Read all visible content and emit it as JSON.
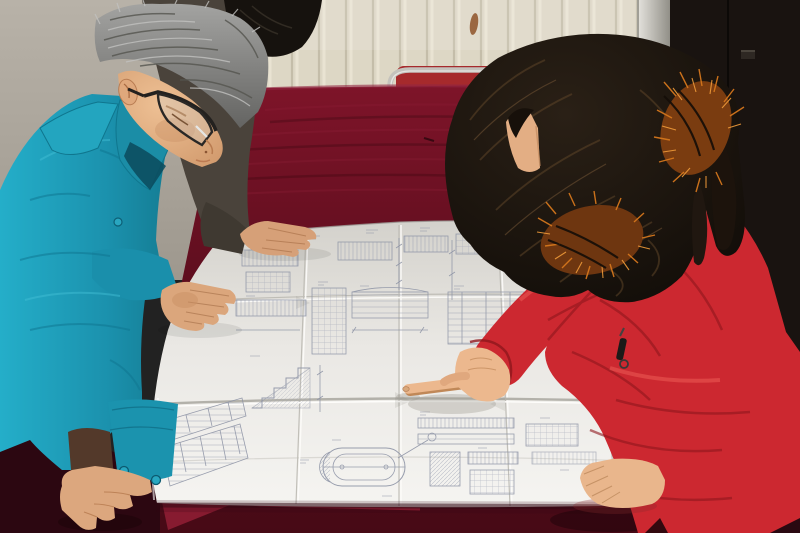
{
  "meta": {
    "type": "photograph",
    "description": "Two workers lean over a large folded engineering blueprint spread on a dark red velvet-covered table. A gray-haired man wearing black glasses and a teal work jacket studies the plans; a woman in a red quilted down coat with an orange fur-trimmed hood points at a detail with her right index finger. A third person in a dark jacket rests a hand on the top of the sheet.",
    "width": 800,
    "height": 533
  },
  "scene": {
    "background": {
      "left_wall": "plain gray plaster wall",
      "center_wall": "cream vertical-panel radiator wall with rust drip stains",
      "right_door": "dark brown metal door with small latch",
      "chair": "metal-tube frame chair with dark red cushion behind the table"
    },
    "table": {
      "covering": "dark burgundy velvet cloth draped over large table"
    },
    "blueprint": {
      "kind": "folded engineering construction drawing",
      "features": [
        "fold creases in a grid pattern",
        "elevation strips with dense tick marks",
        "stair section with hatched fill",
        "rotated title-block tables at lower left",
        "stadium-shaped component detail",
        "hatched section blocks and dimension chains"
      ]
    },
    "people": [
      {
        "id": "man-left",
        "hair": "gray",
        "eyewear": "black rectangular glasses",
        "clothing": "teal work jacket with snap cuffs",
        "pose": "leaning over table, both hands on the sheet"
      },
      {
        "id": "person-behind",
        "hair": "black",
        "clothing": "dark brown jacket",
        "pose": "hand resting on top edge of the sheet"
      },
      {
        "id": "woman-right",
        "hair": "long dark wavy",
        "clothing": "red quilted down coat, orange fur-trimmed hood, black zipper pull",
        "pose": "pointing at the drawing, left hand resting on sheet"
      }
    ]
  },
  "colors": {
    "wall_gray": "#aca69c",
    "wall_cream": "#ddd7c5",
    "panel_shadow": "#c2bba6",
    "panel_light": "#eae5d4",
    "door_dark": "#191310",
    "rust": "#8a4a1e",
    "chair_metal": "#c4c2bc",
    "chair_seat": "#a62a2c",
    "velvet_top": "#7e1429",
    "velvet_mid": "#5e0e1e",
    "velvet_dark": "#470a16",
    "velvet_edge": "#a3223a",
    "velvet_shadow": "#2c0711",
    "paper_mid": "#eae8e4",
    "line_blue": "#8e94a6",
    "jacket_mid": "#1b91ad",
    "jacket_dark": "#13798f",
    "man_hair": "#8f8f8d",
    "skin": "#e2af85",
    "skin_shadow": "#bd8a5c",
    "glasses_black": "#23211f",
    "back_jacket": "#4a433b",
    "back_hair": "#16120e",
    "coat_red": "#cc2830",
    "coat_deep": "#8f161d",
    "woman_hair": "#1b130d",
    "fur_orange": "#d4761c",
    "sleeve_lining": "#53392a"
  }
}
